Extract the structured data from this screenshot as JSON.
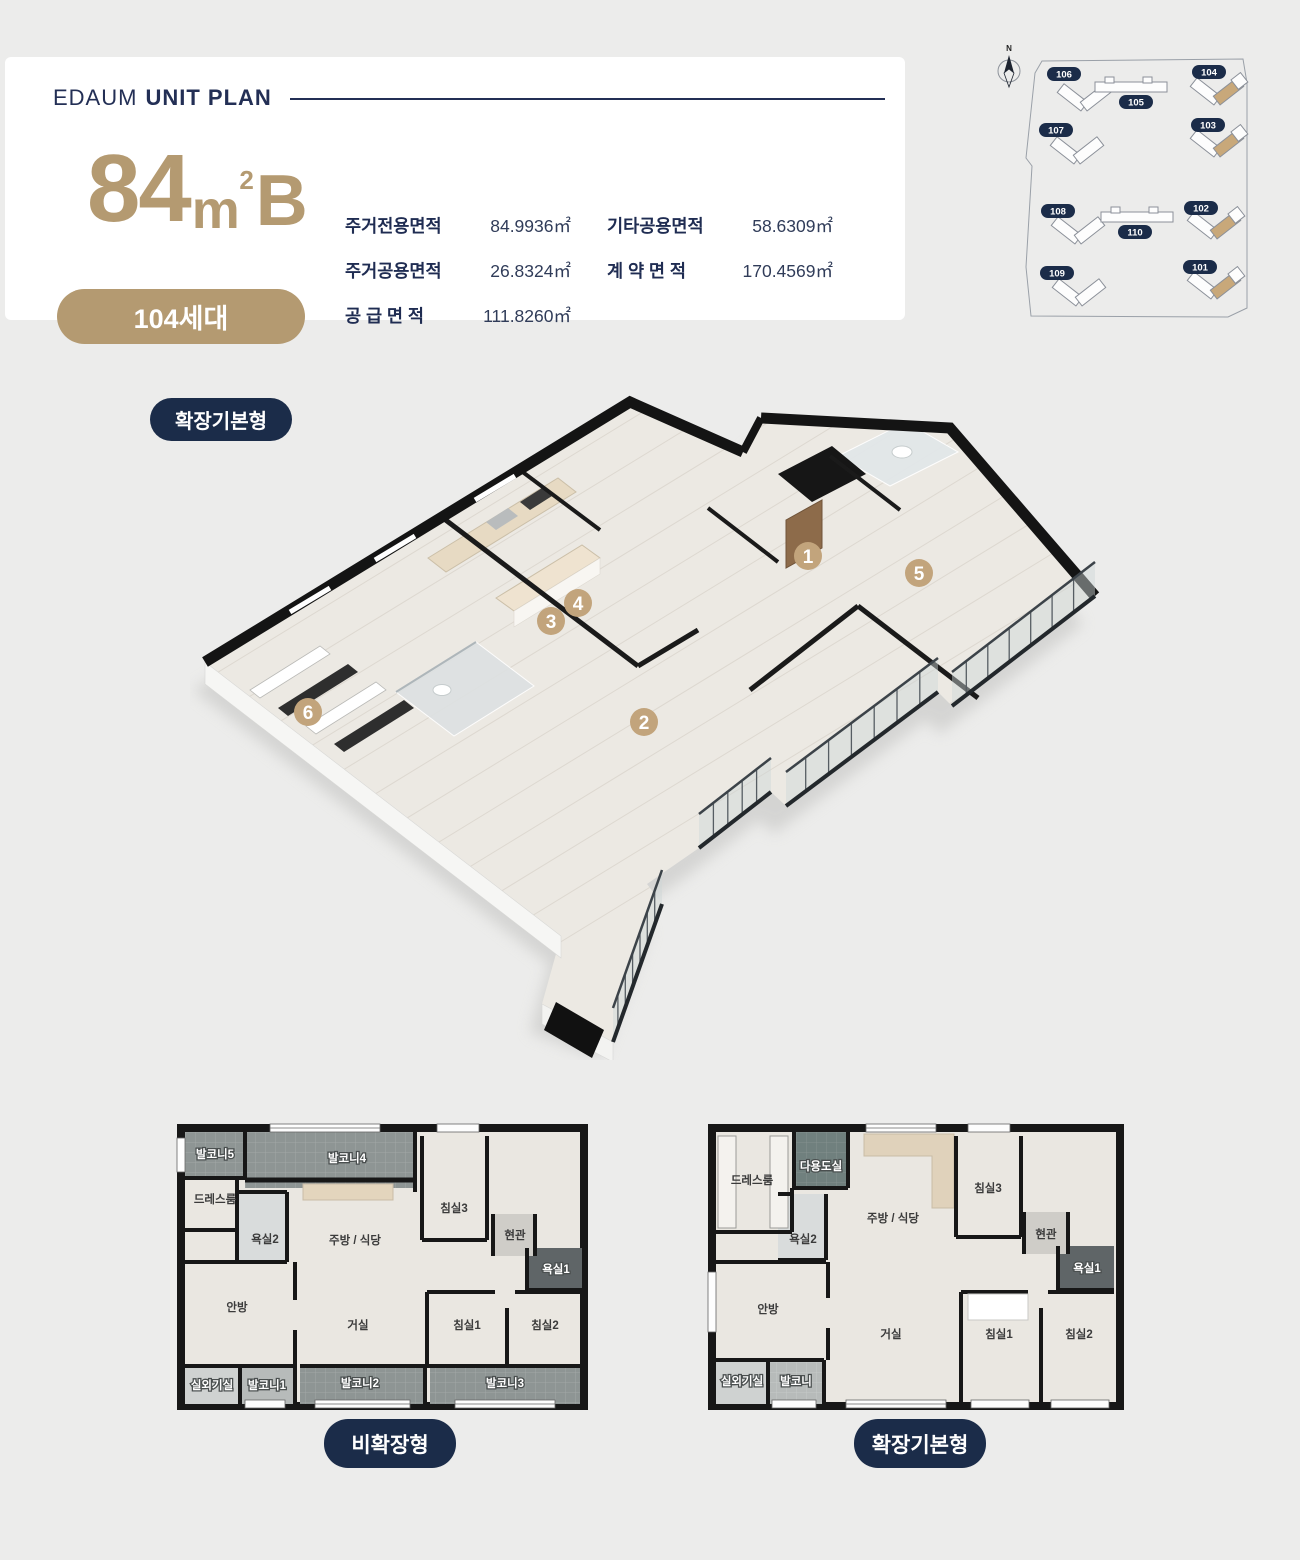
{
  "header": {
    "brand": "EDAUM",
    "title": "UNIT PLAN"
  },
  "unit": {
    "size_number": "84",
    "size_unit": "m",
    "size_sup": "2",
    "size_suffix": "B",
    "households": "104세대"
  },
  "areas": [
    {
      "label": "주거전용면적",
      "value": "84.9936㎡"
    },
    {
      "label": "기타공용면적",
      "value": "58.6309㎡"
    },
    {
      "label": "주거공용면적",
      "value": "26.8324㎡"
    },
    {
      "label": "계 약 면 적",
      "value": "170.4569㎡"
    },
    {
      "label": "공 급 면 적",
      "value": "111.8260㎡"
    }
  ],
  "site_map": {
    "compass_label": "N",
    "buildings": [
      {
        "id": "106",
        "highlighted": false
      },
      {
        "id": "105",
        "highlighted": false
      },
      {
        "id": "104",
        "highlighted": true
      },
      {
        "id": "107",
        "highlighted": false
      },
      {
        "id": "103",
        "highlighted": true
      },
      {
        "id": "108",
        "highlighted": false
      },
      {
        "id": "110",
        "highlighted": false
      },
      {
        "id": "102",
        "highlighted": true
      },
      {
        "id": "109",
        "highlighted": false
      },
      {
        "id": "101",
        "highlighted": true
      }
    ]
  },
  "plan3d": {
    "type_badge": "확장기본형",
    "markers": [
      "1",
      "2",
      "3",
      "4",
      "5",
      "6"
    ]
  },
  "floor_plans": {
    "left": {
      "caption": "비확장형",
      "rooms": [
        "발코니5",
        "발코니4",
        "드레스룸",
        "욕실2",
        "주방 / 식당",
        "침실3",
        "현관",
        "욕실1",
        "안방",
        "거실",
        "침실1",
        "침실2",
        "실외기실",
        "발코니1",
        "발코니2",
        "발코니3"
      ]
    },
    "right": {
      "caption": "확장기본형",
      "rooms": [
        "드레스룸",
        "다용도실",
        "주방 / 식당",
        "침실3",
        "현관",
        "욕실2",
        "욕실1",
        "안방",
        "거실",
        "침실1",
        "침실2",
        "실외기실",
        "발코니"
      ]
    }
  },
  "colors": {
    "navy": "#1b2c49",
    "gold": "#b49a71",
    "marker_gold": "#c2a47c"
  }
}
